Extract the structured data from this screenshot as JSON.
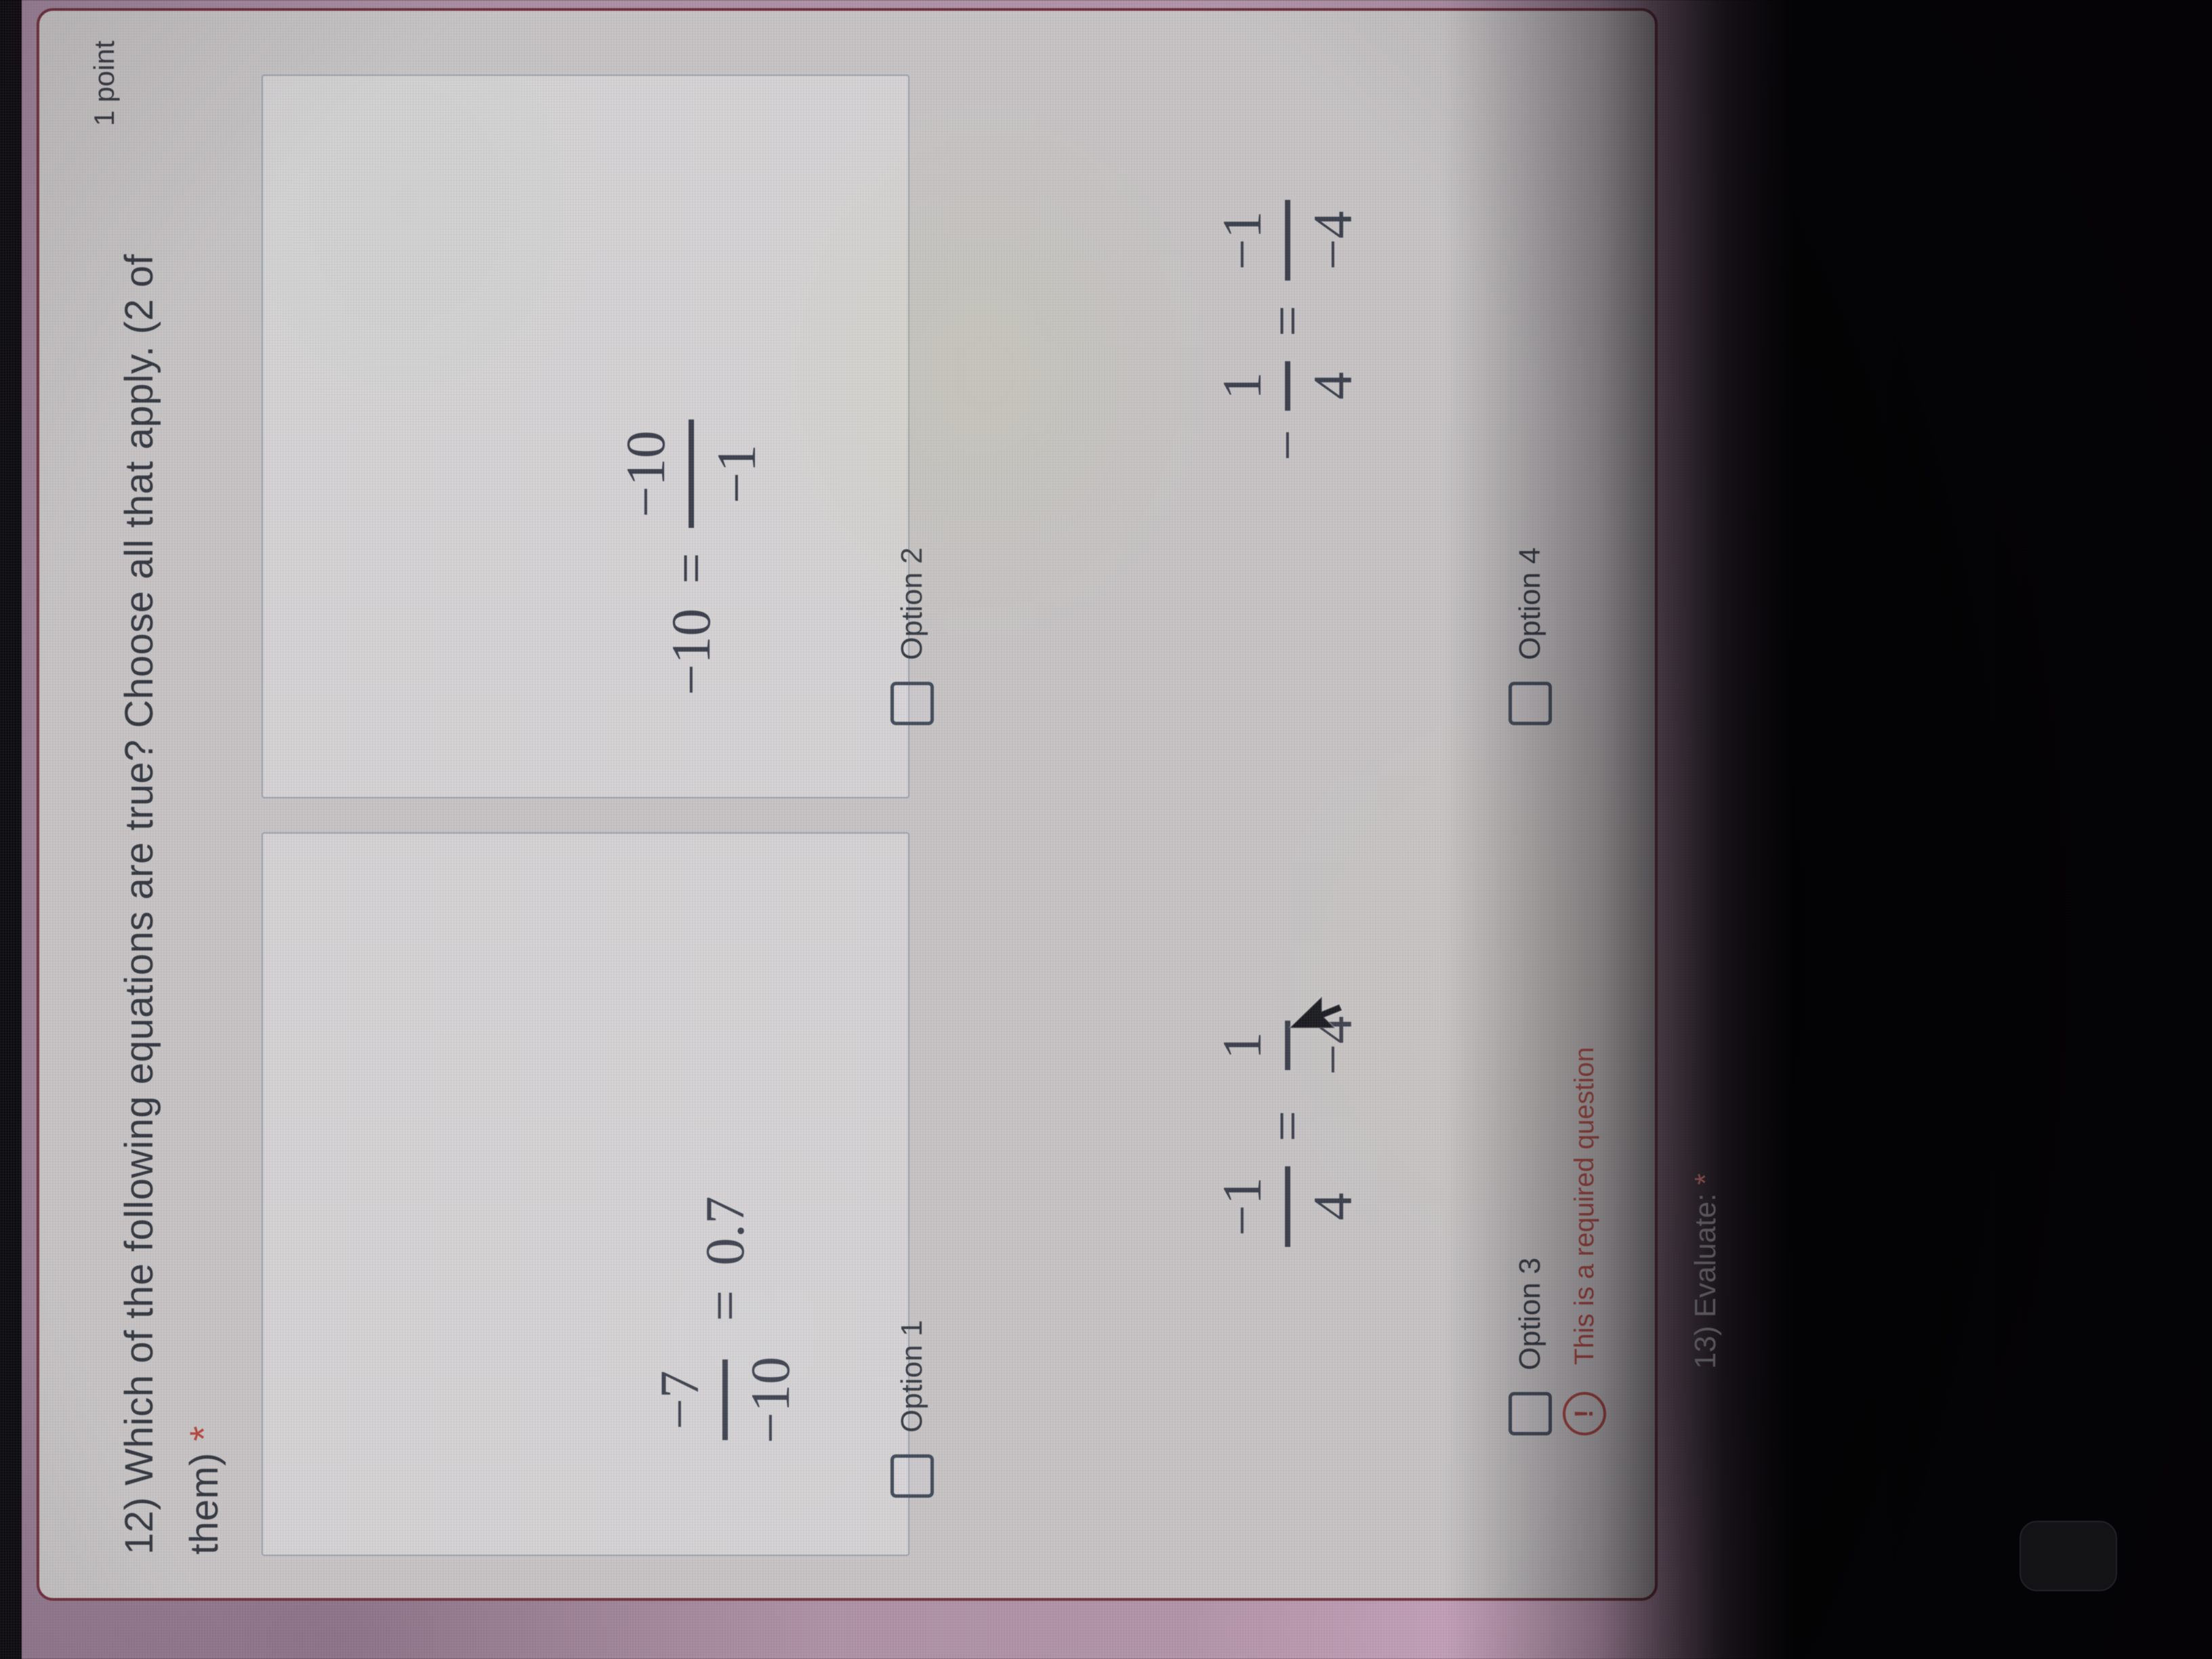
{
  "question12": {
    "title_line1": "12) Which of the following equations are true? Choose all that apply. (2 of",
    "title_line2": "them)",
    "required_mark": "*",
    "points": "1 point",
    "error_icon": "!",
    "error_message": "This is a required question",
    "options": [
      {
        "label": "Option 1",
        "equation": {
          "lhs_num": "−7",
          "lhs_den": "−10",
          "equals": "=",
          "rhs": "0.7"
        }
      },
      {
        "label": "Option 2",
        "equation": {
          "lhs": "−10",
          "equals": "=",
          "rhs_num": "−10",
          "rhs_den": "−1"
        }
      },
      {
        "label": "Option 3",
        "equation": {
          "lhs_num": "−1",
          "lhs_den": "4",
          "equals": "=",
          "rhs_num": "1",
          "rhs_den": "−4"
        }
      },
      {
        "label": "Option 4",
        "equation": {
          "lhs_pre": "−",
          "lhs_num": "1",
          "lhs_den": "4",
          "equals": "=",
          "rhs_num": "−1",
          "rhs_den": "−4"
        }
      }
    ]
  },
  "question13": {
    "title": "13) Evaluate:",
    "required_mark": "*"
  },
  "colors": {
    "card_error_border": "#6e2f3c",
    "error_red": "#ad453e",
    "page_purple": "#a98ca1",
    "text_dark": "#32363e"
  }
}
